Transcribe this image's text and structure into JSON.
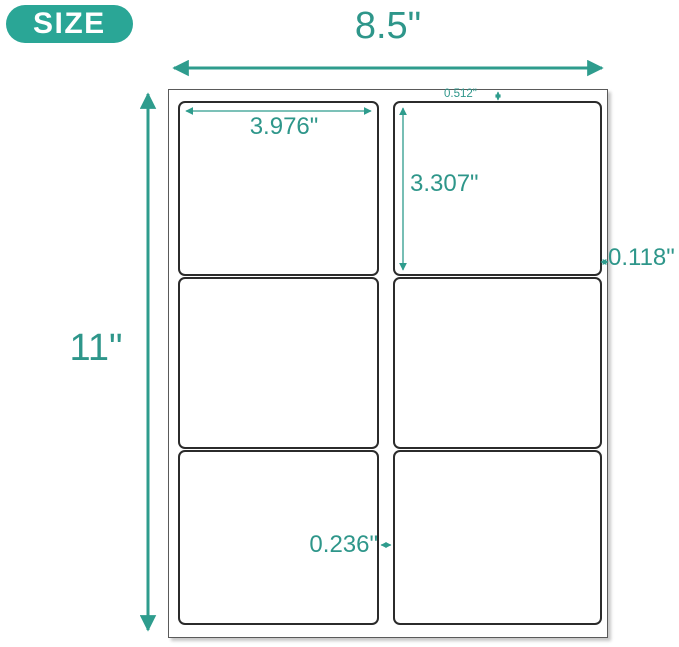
{
  "badge": {
    "label": "SIZE"
  },
  "colors": {
    "accent_badge": "#2AA696",
    "accent_line": "#2E9C8D",
    "accent_text": "#2E968A",
    "label_border": "#2b2b2b",
    "sheet_border": "#5a5a5a"
  },
  "dimensions": {
    "sheet_width": "8.5\"",
    "sheet_height": "11\"",
    "label_width": "3.976\"",
    "label_height": "3.307\"",
    "top_margin": "0.512\"",
    "side_margin": "0.118\"",
    "column_gap": "0.236\""
  },
  "grid": {
    "rows": 3,
    "columns": 2,
    "labels_total": 6
  }
}
